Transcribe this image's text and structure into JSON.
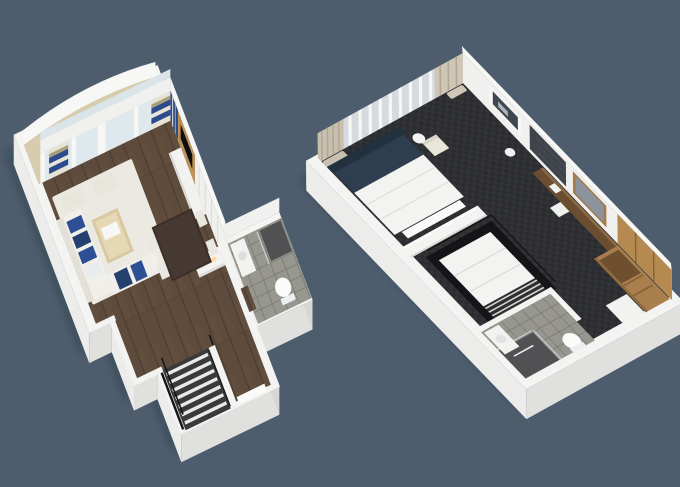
{
  "canvas": {
    "width": 680,
    "height": 487
  },
  "scene": {
    "type": "3d-floor-plan-rendering",
    "floors": [
      {
        "id": "lower-level",
        "rooms": [
          "balcony",
          "living-room",
          "dining-area",
          "hallway",
          "bathroom",
          "staircase",
          "entry"
        ],
        "furniture": [
          "striped-curtains",
          "armchairs",
          "sectional-sofa",
          "blue-cushions",
          "coffee-table",
          "area-rug",
          "tv-panel-wall",
          "media-console",
          "dining-table",
          "dining-chairs",
          "bar-counter",
          "toilet",
          "sink",
          "shower",
          "stairs-with-railing",
          "entry-door",
          "balcony-table"
        ]
      },
      {
        "id": "upper-level",
        "rooms": [
          "bedroom",
          "bathroom",
          "stairwell",
          "wardrobe-area"
        ],
        "furniture": [
          "beige-curtains",
          "window-railing",
          "armchair",
          "side-table",
          "bed",
          "headboard",
          "wall-art",
          "accent-panel",
          "mirror",
          "desk",
          "desk-chair",
          "stool",
          "wardrobe-shelves",
          "dresser-cabinet",
          "toilet",
          "sink",
          "shower",
          "stair-railing"
        ]
      }
    ]
  },
  "palette": {
    "background": "#4d5d6e",
    "slab": "#f4f4f2",
    "balcony_floor": "#d8ccae",
    "wood_floor": "#5e4b3c",
    "carpet": "#2b2c2e",
    "tile": "#97978f",
    "rug": "#ebe9e2",
    "sofa": "#f1efe9",
    "cushion_blue": "#2d4f94",
    "cushion_navy": "#23406e",
    "armchair": "#e8e5db",
    "coffee_table": "#d9c89f",
    "dining_table": "#3a2f27",
    "chair": "#e9e7e1",
    "tv_wood": "#bd9358",
    "tv_screen": "#0e0e0e",
    "curtain_blue": "#2c4a8c",
    "curtain_cream": "#e6e3d4",
    "curtain_tan": "#a89f78",
    "curtain_beige": "#c9bfae",
    "stair_carpet": "#3a3a3c",
    "railing": "#141414",
    "bed_linen": "#f3f3f1",
    "bed_navy": "#2e3d50",
    "headboard": "#223140",
    "wardrobe": "#a97f4e",
    "wardrobe_light": "#b68950",
    "shower": "#515153",
    "mirror_frame": "#a57c49",
    "mirror_glass": "#8b949c",
    "art": "#414750",
    "accent_panel": "#3f444b",
    "fixture": "#fbfbf9",
    "light_warm": "#ffd9a0"
  }
}
